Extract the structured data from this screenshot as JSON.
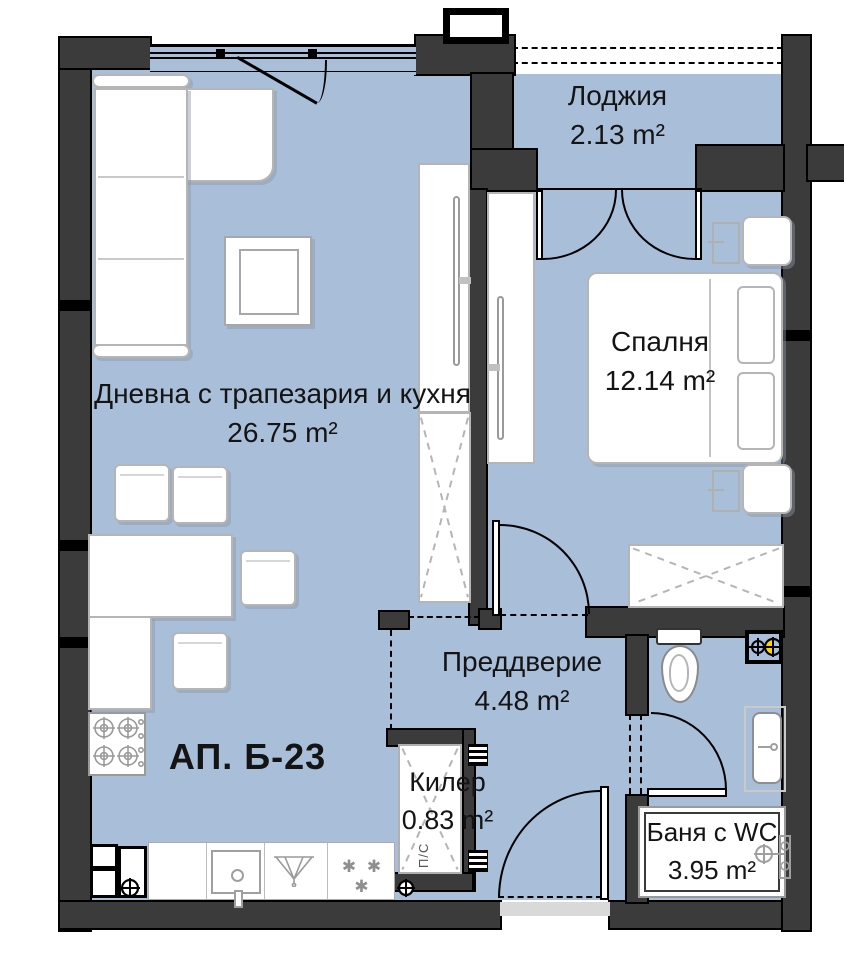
{
  "apartment": {
    "label": "АП. Б-23"
  },
  "rooms": {
    "living": {
      "name": "Дневна с трапезария и кухня",
      "area": "26.75 m²"
    },
    "loggia": {
      "name": "Лоджия",
      "area": "2.13 m²"
    },
    "bedroom": {
      "name": "Спалня",
      "area": "12.14 m²"
    },
    "hall": {
      "name": "Преддверие",
      "area": "4.48 m²"
    },
    "closet": {
      "name": "Килер",
      "area": "0.83 m²",
      "appliance_label": "П/С"
    },
    "bath": {
      "name": "Баня с WC",
      "area": "3.95 m²"
    }
  },
  "symbols": {
    "cooktop_burners": "✱ ✱ ✱"
  },
  "colors": {
    "floor": "#a9bed9",
    "wall": "#3b3b3c",
    "vent_highlight": "#ffd400"
  }
}
